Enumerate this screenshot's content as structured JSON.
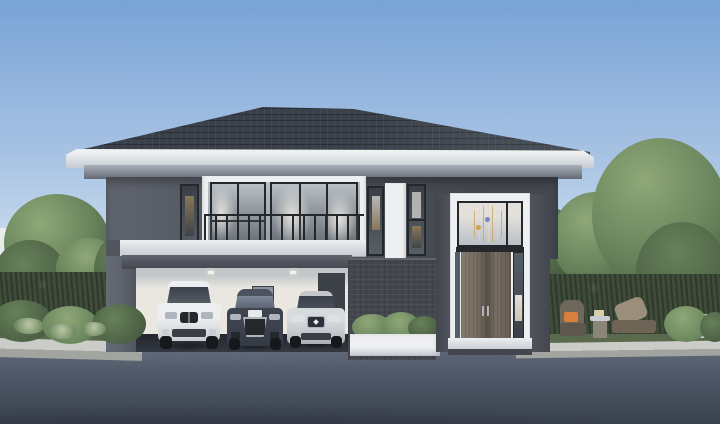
{
  "scene": {
    "title": "Modern two-storey detached house exterior rendering",
    "time_of_day": "daytime",
    "elements": {
      "house": {
        "roof": "dark hip roof with tile texture",
        "upper_floor": "dark grey wall, bedroom balcony with glass railing, narrow accent windows",
        "entrance_tower": "double-height white-framed glass entrance with wooden double door and hanging decor",
        "garage": {
          "label": "open 3-bay garage",
          "cars": [
            {
              "name": "white-suv",
              "color_key": "car_white"
            },
            {
              "name": "dark-coupe",
              "color_key": "car_dark"
            },
            {
              "name": "silver-sedan",
              "color_key": "car_silver"
            }
          ]
        },
        "planter": "white planter box with shrubs"
      },
      "landscape": {
        "left": "large tree, hedge, pale broad-leaf plants, light fence behind",
        "right": "tall trees, hedge, patio with wicker chair, orange cushion, side table, lounge chair",
        "foreground": "asphalt road with light concrete curbs"
      }
    }
  },
  "palette": {
    "sky_top": "#79a3d6",
    "sky_mid": "#a9c4e4",
    "sky_low": "#cfdff0",
    "sky_horizon": "#eef3f8",
    "roof": "#394049",
    "soffit_light": "#eef0f2",
    "soffit_shade": "#c6ccd2",
    "molding_light": "#aab1b9",
    "molding_dark": "#646b75",
    "wall": "#51555e",
    "wall_light": "#60646d",
    "wall_dark": "#43464e",
    "trim": "#edeff0",
    "frame_dark": "#24272c",
    "glass": "#8b939b",
    "glass_light": "#b9c0c6",
    "glass_dark": "#565e66",
    "curtain": "#e3e0db",
    "interior_warm": "#9c8258",
    "interior_dark": "#3a3f46",
    "wood_door": "#776e62",
    "garage_wall": "#eae7e1",
    "garage_ceiling": "#c2c6c9",
    "garage_floor": "#23272d",
    "garage_door_inner": "#3c4047",
    "road": "#4d5666",
    "road_light": "#5f6877",
    "road_dark": "#39414f",
    "curb_top": "#cbccc8",
    "curb_face": "#a2a4a0",
    "grass": "#5a6b4d",
    "hedge": "#3f4c3a",
    "foliage_light": "#8fa878",
    "foliage_mid": "#66815a",
    "foliage_dark": "#46583f",
    "trunk": "#4b4238",
    "plant_pale": "#b9c7a4",
    "car_white": "#eceeef",
    "car_white_shade": "#c9cdd1",
    "car_dark": "#3d4450",
    "car_silver": "#c3c7cb",
    "car_glass": "#3a404a",
    "wheel": "#16181c",
    "chrome": "#aeb5bc",
    "cushion": "#d97e3c",
    "wicker": "#6e675c",
    "lounge": "#9b8e7b",
    "fence_light": "#e9edee",
    "planter_white": "#eff0f1"
  }
}
